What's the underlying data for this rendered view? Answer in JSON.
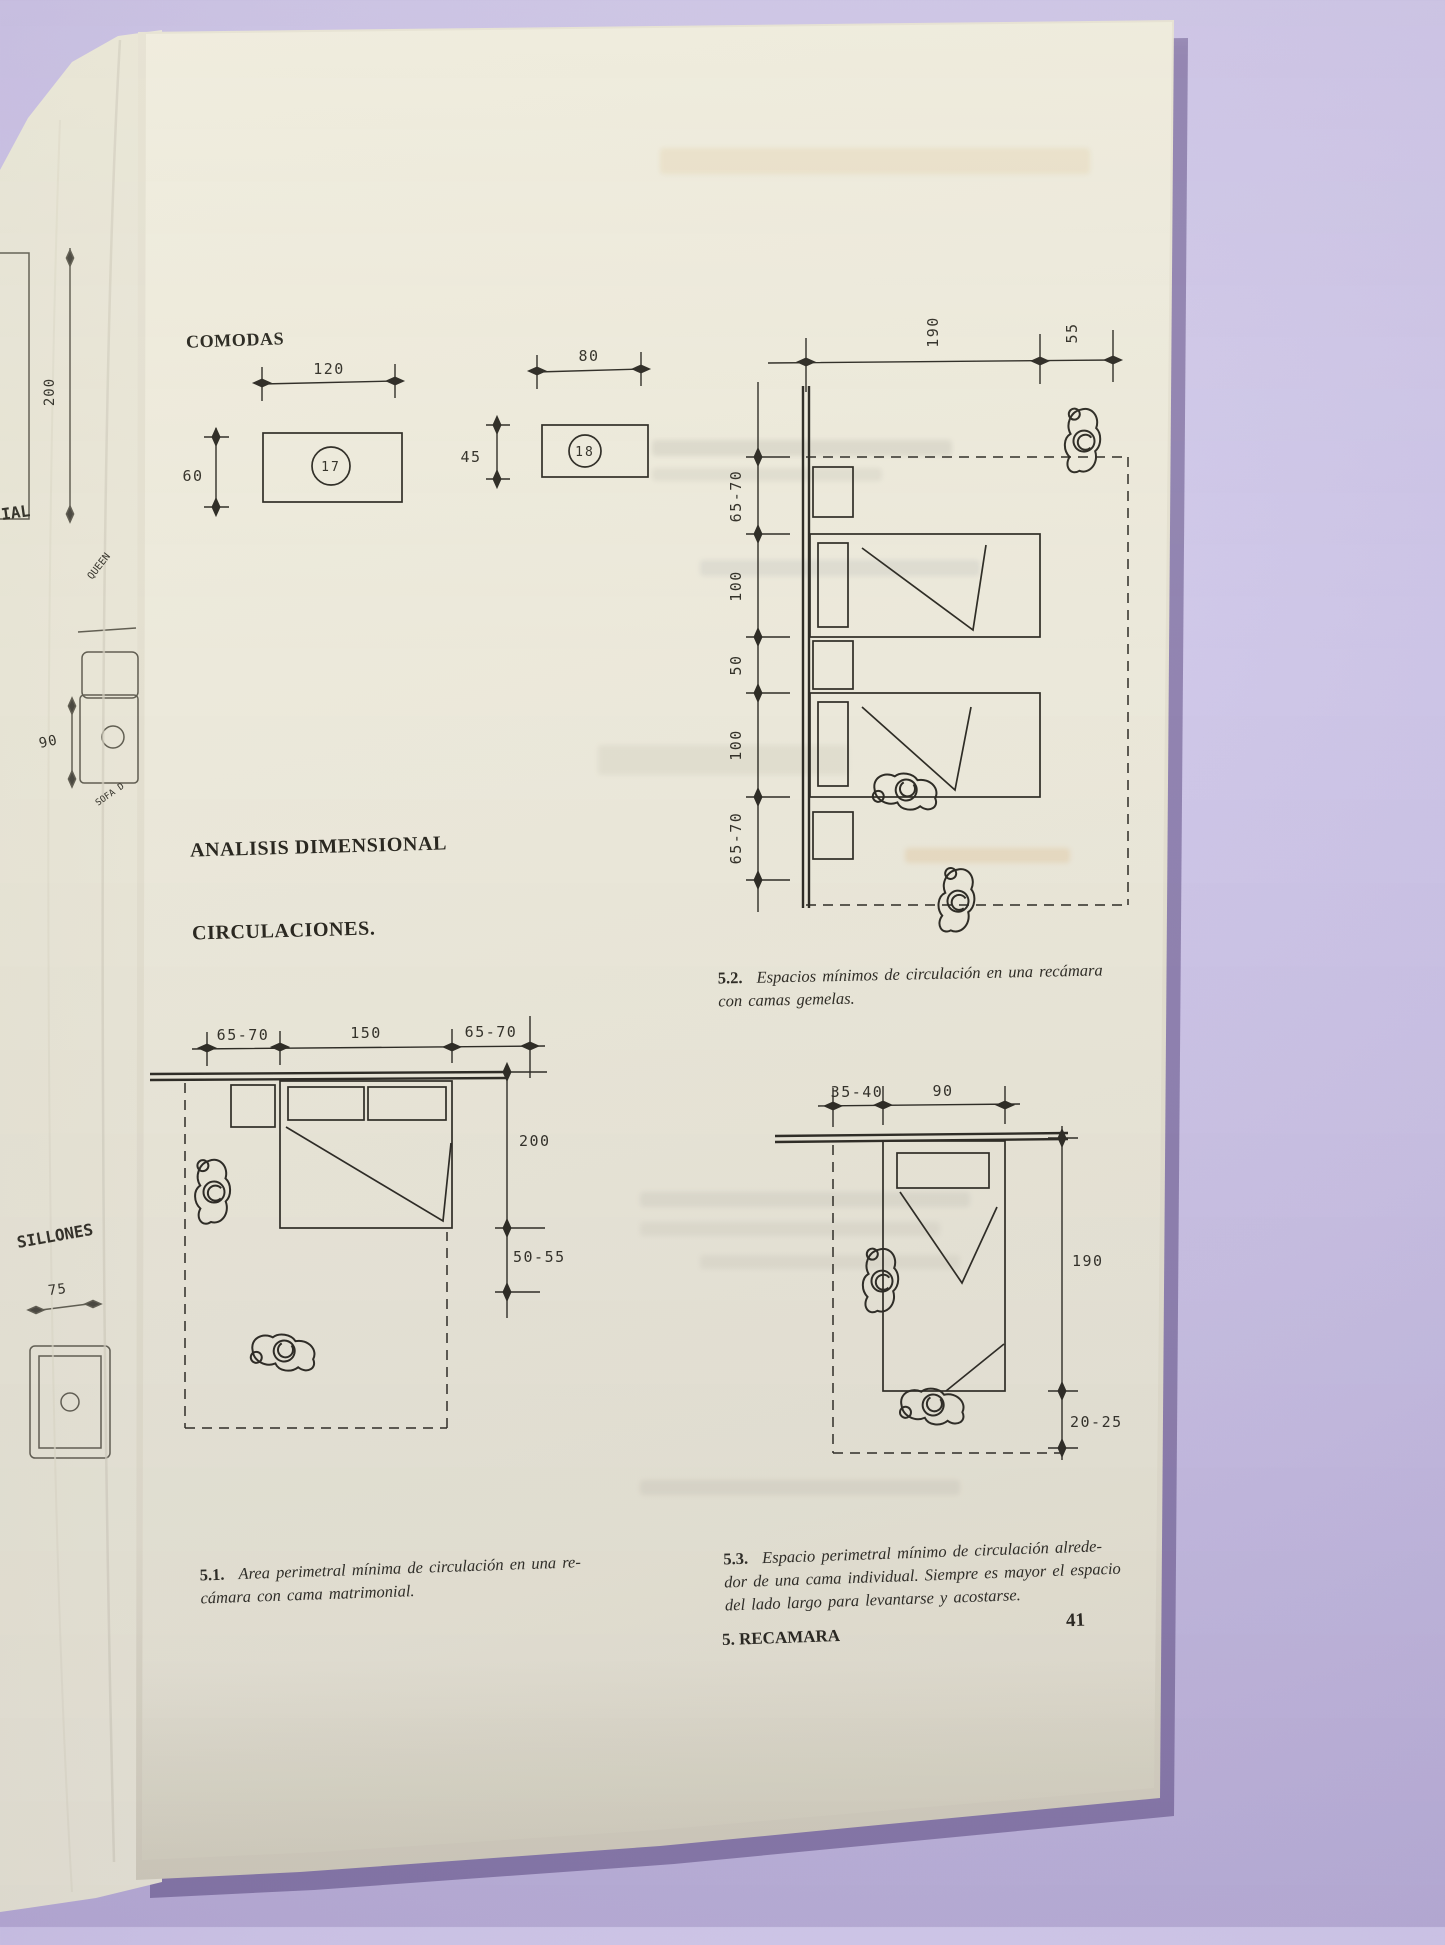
{
  "book": {
    "page_number": "41",
    "section_footer": "5. RECAMARA"
  },
  "headings": {
    "comodas": "COMODAS",
    "analisis_dimensional": "ANALISIS DIMENSIONAL",
    "circulaciones": "CIRCULACIONES."
  },
  "comodas_figures": {
    "dresser_17": {
      "number": "17",
      "width": "120",
      "depth": "60"
    },
    "dresser_18": {
      "number": "18",
      "width": "80",
      "depth": "45"
    }
  },
  "figure_5_1": {
    "top_dims": {
      "left": "65-70",
      "center": "150",
      "right": "65-70"
    },
    "side_dims": {
      "length": "200",
      "foot": "50-55"
    },
    "caption_number": "5.1.",
    "caption_line1": "Area perimetral mínima de circulación en una re-",
    "caption_line2": "cámara con cama matrimonial."
  },
  "figure_5_2": {
    "top_dims": {
      "length": "190",
      "foot": "55"
    },
    "side_dims": [
      "65-70",
      "100",
      "50",
      "100",
      "65-70"
    ],
    "caption_number": "5.2.",
    "caption_line1": "Espacios mínimos de circulación en una recámara",
    "caption_line2": "con camas gemelas."
  },
  "figure_5_3": {
    "top_dims": {
      "side": "35-40",
      "width": "90"
    },
    "side_dims": {
      "length": "190",
      "foot": "20-25"
    },
    "caption_number": "5.3.",
    "caption_line1": "Espacio perimetral mínimo de circulación alrede-",
    "caption_line2": "dor de una cama individual. Siempre es mayor el espacio",
    "caption_line3": "del lado largo para levantarse y acostarse."
  },
  "previous_page_fragments": {
    "partial_label": "IAL",
    "queen": "QUEEN",
    "dim_200": "200",
    "dim_90": "90",
    "sofa": "SOFA D",
    "sillones": "SILLONES",
    "dim_75": "75"
  },
  "colors": {
    "background_purple": "#c9c0e3",
    "paper": "#ebe8da",
    "ink": "#2f2d26"
  }
}
